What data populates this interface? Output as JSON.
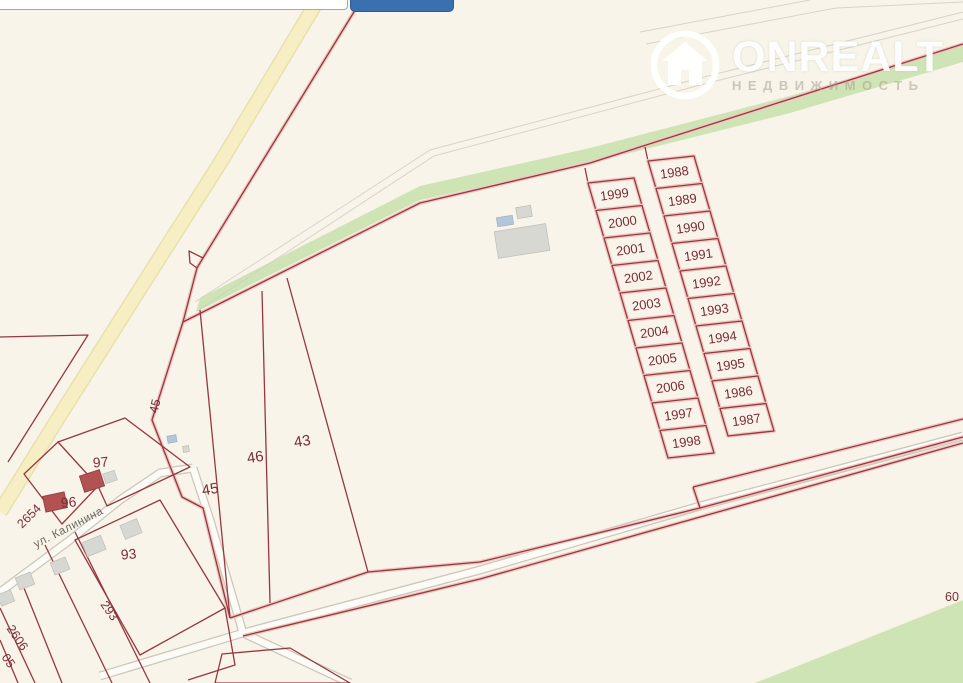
{
  "watermark": {
    "brand": "ONREALT",
    "subtitle": "НЕДВИЖИМОСТЬ"
  },
  "map": {
    "street_label": "ул. Калинина",
    "parcel_columns": {
      "left": [
        "1999",
        "2000",
        "2001",
        "2002",
        "2003",
        "2004",
        "2005",
        "2006",
        "1997",
        "1998"
      ],
      "right": [
        "1988",
        "1989",
        "1990",
        "1991",
        "1992",
        "1993",
        "1994",
        "1995",
        "1986",
        "1987"
      ]
    },
    "parcel_labels": [
      {
        "text": "45",
        "x": 159,
        "y": 407,
        "rot": -77,
        "size": 12.5
      },
      {
        "text": "45",
        "x": 211,
        "y": 494,
        "rot": -10,
        "size": 15
      },
      {
        "text": "46",
        "x": 256,
        "y": 462,
        "rot": -9,
        "size": 15
      },
      {
        "text": "43",
        "x": 303,
        "y": 446,
        "rot": -9,
        "size": 15
      },
      {
        "text": "97",
        "x": 101,
        "y": 467,
        "rot": -5,
        "size": 14
      },
      {
        "text": "96",
        "x": 69,
        "y": 507,
        "rot": -5,
        "size": 14
      },
      {
        "text": "2654",
        "x": 32,
        "y": 519,
        "rot": -45,
        "size": 12.5
      },
      {
        "text": "93",
        "x": 129,
        "y": 559,
        "rot": -5,
        "size": 14
      },
      {
        "text": "293",
        "x": 106,
        "y": 613,
        "rot": 55,
        "size": 12.5
      },
      {
        "text": "2606",
        "x": 14,
        "y": 640,
        "rot": 56,
        "size": 12.5
      },
      {
        "text": "05",
        "x": 5,
        "y": 663,
        "rot": 56,
        "size": 12.5
      },
      {
        "text": "60",
        "x": 945,
        "y": 601,
        "rot": 0,
        "size": 12.5,
        "anchor": "start"
      }
    ],
    "colors": {
      "background": "#f8f4e9",
      "boundary": "#96383f",
      "boundary_halo": "#eec6c1",
      "label": "#7b2d39",
      "green": "#cfe4b4",
      "road_yellow": "#f7efc3"
    }
  }
}
